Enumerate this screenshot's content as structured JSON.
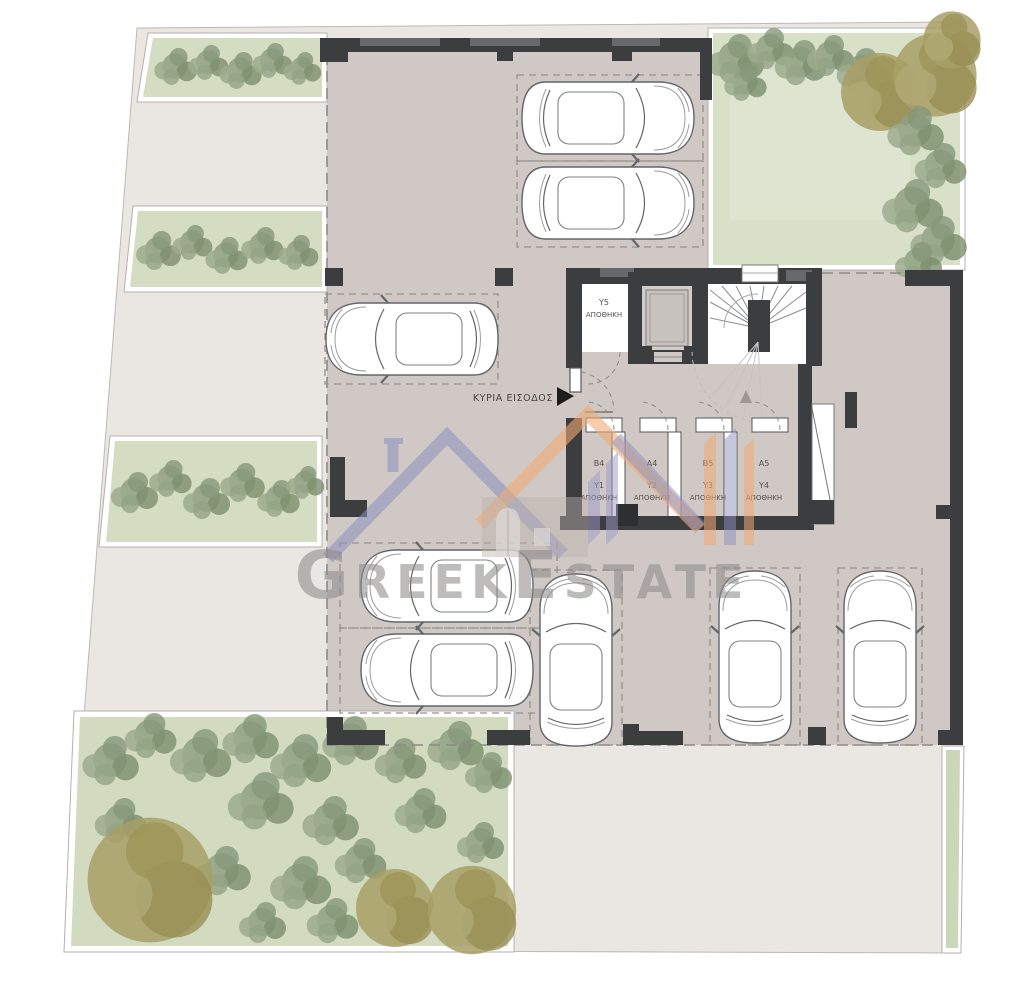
{
  "watermark": {
    "text": "GreekEstate"
  },
  "entrance": {
    "label": "ΚΥΡΙΑ ΕΙΣΟΔΟΣ"
  },
  "storages": [
    {
      "unit": "B4",
      "code": "Y1",
      "word": "ΑΠΟΘΗΚΗ"
    },
    {
      "unit": "A4",
      "code": "Y2",
      "word": "ΑΠΟΘΗΚΗ"
    },
    {
      "unit": "B5",
      "code": "Y3",
      "word": "ΑΠΟΘΗΚΗ"
    },
    {
      "unit": "A5",
      "code": "Y4",
      "word": "ΑΠΟΘΗΚΗ"
    },
    {
      "code": "Y5",
      "word": "ΑΠΟΘΗΚΗ"
    }
  ],
  "colors": {
    "pavement": "#eae6e2",
    "floor": "#cfc8c4",
    "garden": "#d6decb",
    "wall": "#3c3d3f",
    "watermark_blue": "#8b8fc0",
    "watermark_orange": "#f0aa74",
    "watermark_text": "#8f8c8a"
  }
}
